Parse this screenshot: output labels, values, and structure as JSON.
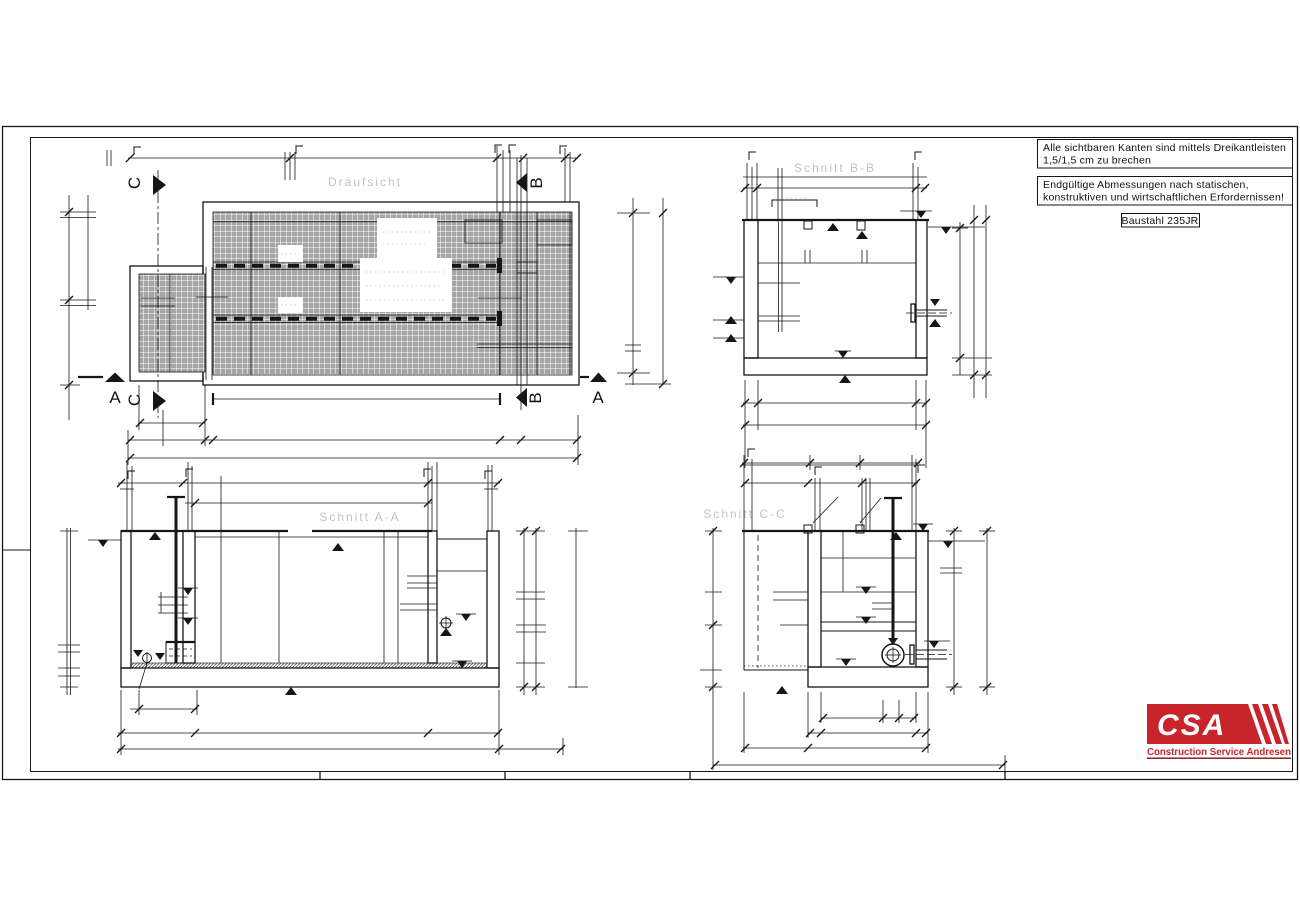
{
  "sheet": {
    "background": "#ffffff",
    "line_color": "#161616",
    "plan_fill": "#a6a6a6"
  },
  "notes": {
    "note1_line1": "Alle sichtbaren Kanten sind mittels Dreikantleisten",
    "note1_line2": "1,5/1,5 cm zu brechen",
    "note2_line1": "Endgültige Abmessungen nach statischen,",
    "note2_line2": "konstruktiven und wirtschaftlichen Erfordernissen!",
    "material_note": "Baustahl 235JR"
  },
  "views": {
    "plan": {
      "title": "Draufsicht"
    },
    "section_aa": {
      "title": "Schnitt A-A"
    },
    "section_bb": {
      "title": "Schnitt B-B"
    },
    "section_cc": {
      "title": "Schnitt C-C"
    }
  },
  "markers": {
    "a": "A",
    "b": "B",
    "c": "C"
  },
  "logo": {
    "acronym": "CSA",
    "company": "Construction Service Andresen",
    "color": "#c8242c",
    "underline_color": "#7e1616"
  }
}
